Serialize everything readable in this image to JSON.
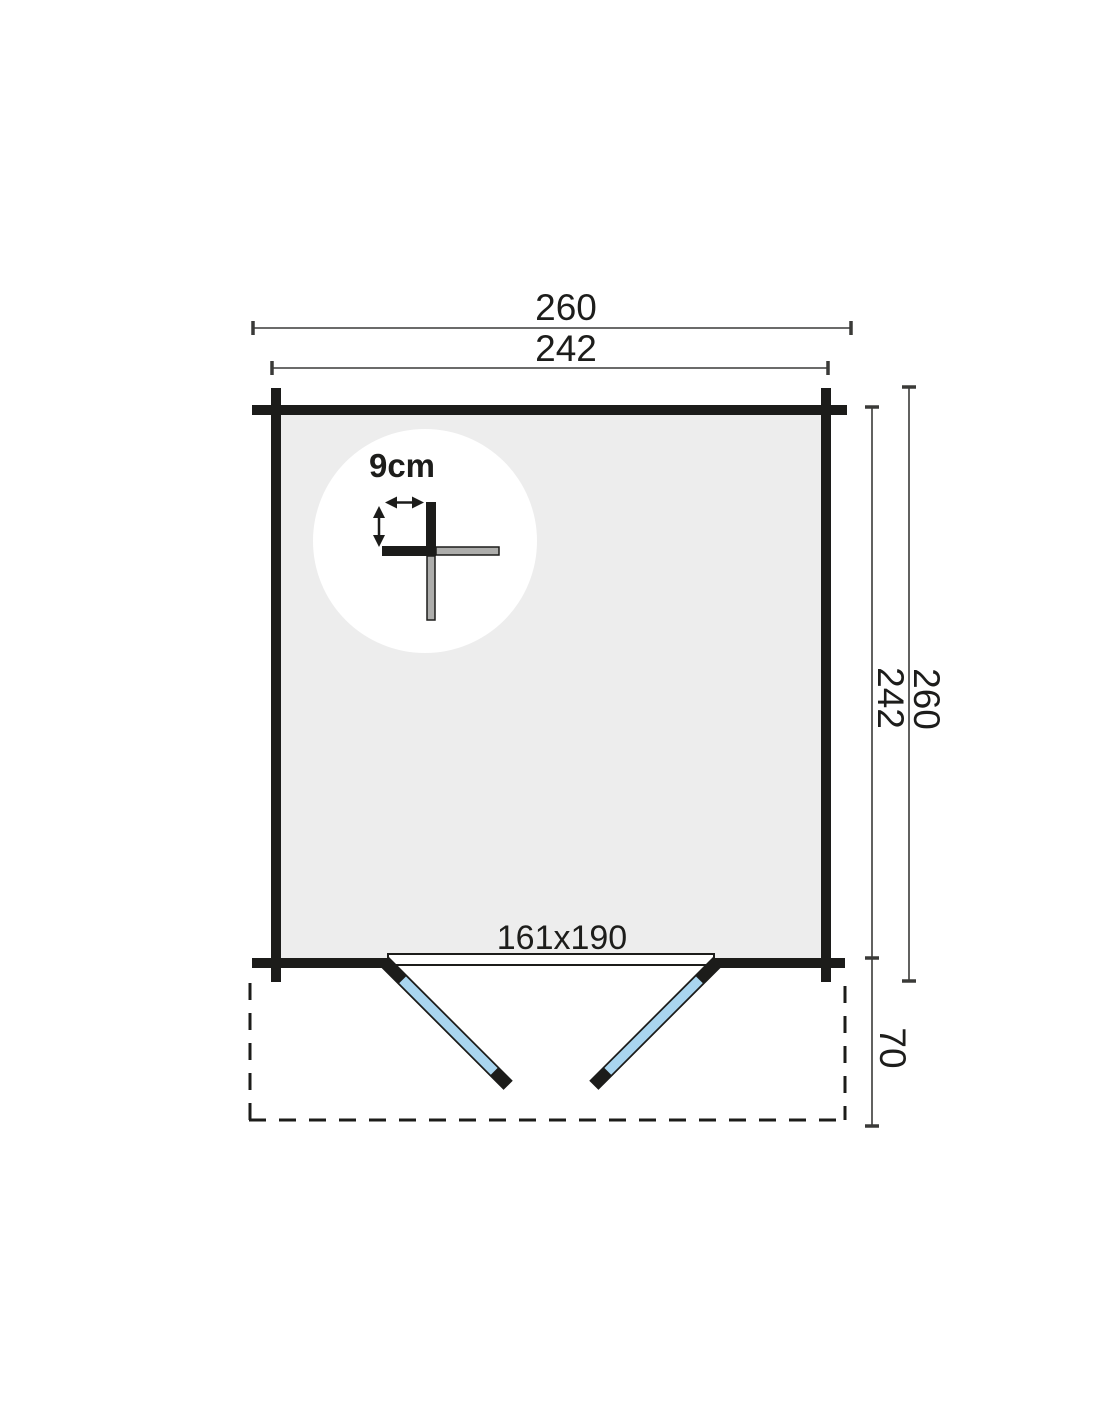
{
  "plan": {
    "top_dimensions": {
      "outer": "260",
      "inner": "242"
    },
    "side_dimensions": {
      "inner": "242",
      "outer": "260",
      "terrace": "70"
    },
    "door": {
      "size_label": "161x190"
    },
    "wall": {
      "thickness_label": "9cm"
    },
    "colors": {
      "wall_black": "#1c1c1a",
      "floor_gray": "#ededed",
      "door_glass_blue": "#a9d5ef",
      "log_gray": "#adadab",
      "dimension_line": "#3a3a38",
      "background": "#ffffff"
    }
  }
}
